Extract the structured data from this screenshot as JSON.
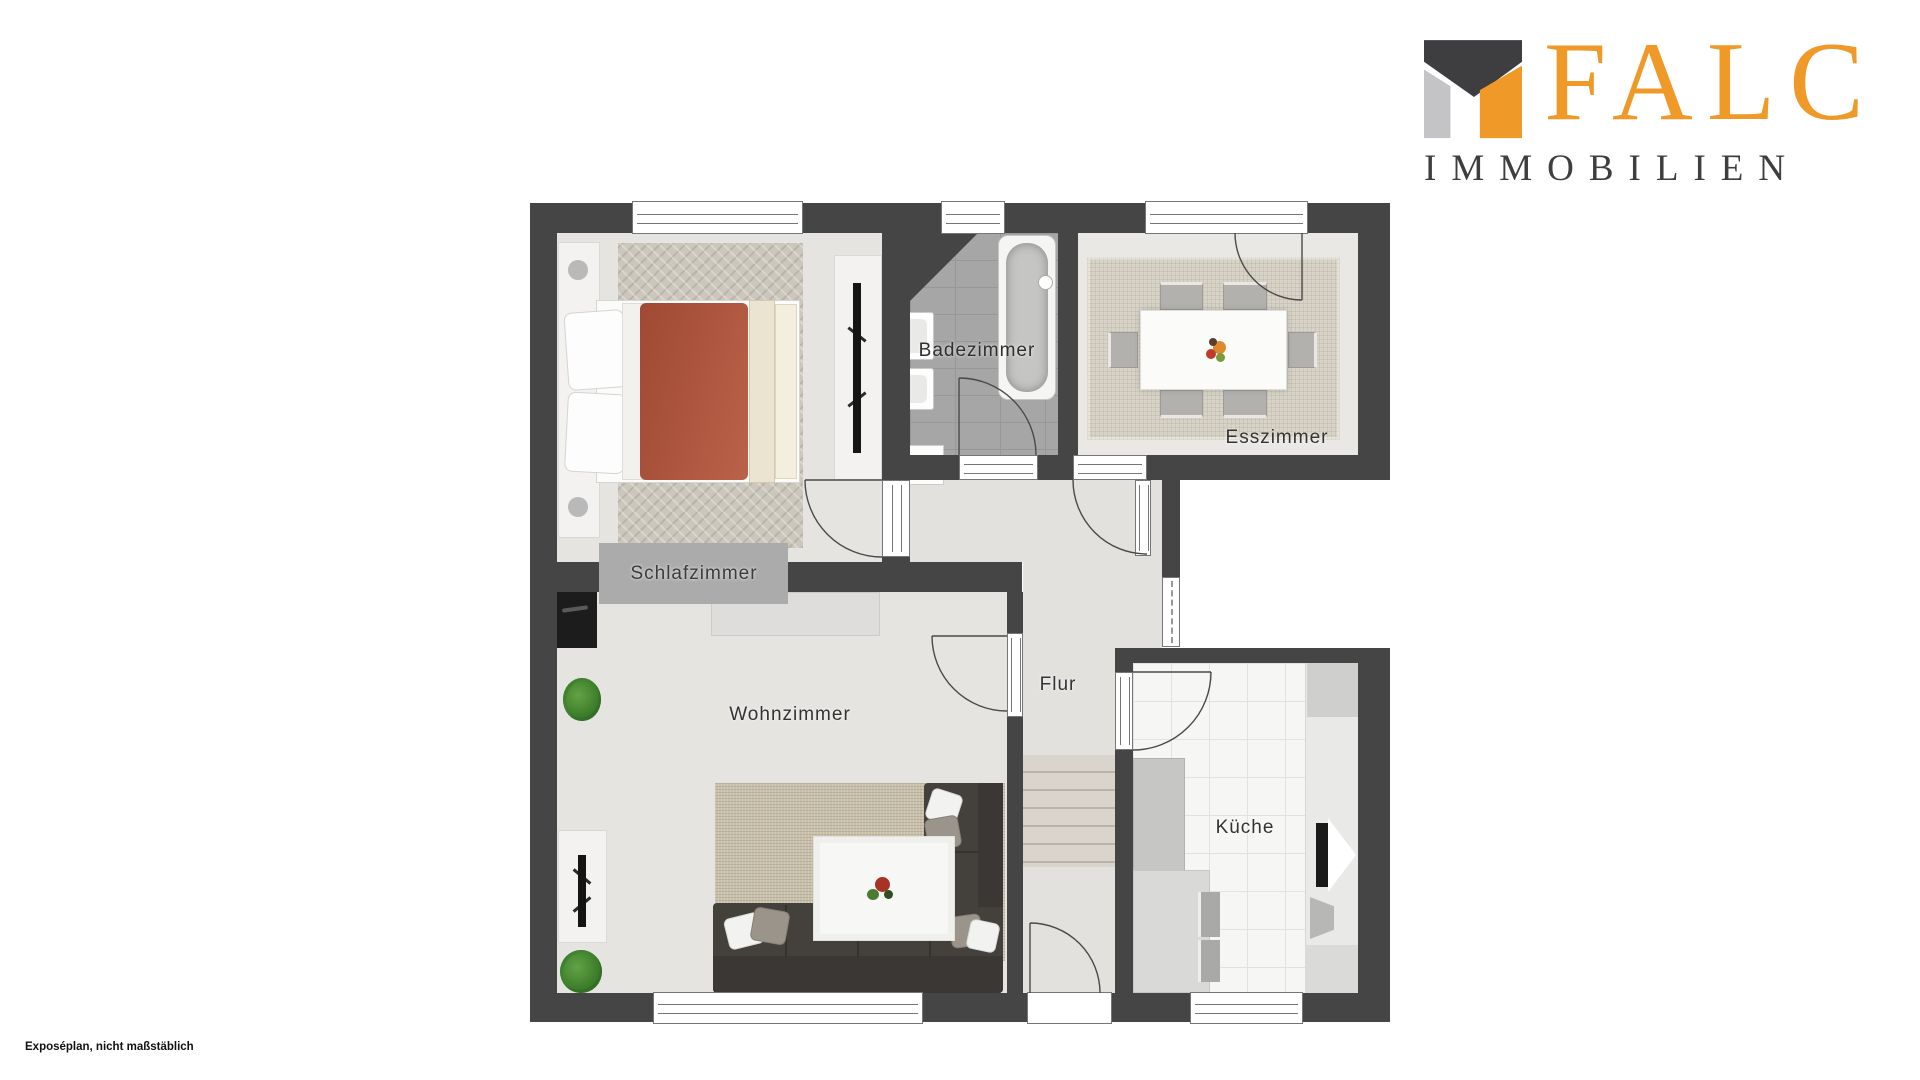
{
  "logo": {
    "brand": "FALC",
    "subtitle": "IMMOBILIEN",
    "colors": {
      "orange": "#EF9A28",
      "dark": "#3E3E40",
      "light_gray": "#C4C4C6"
    }
  },
  "footnote": "Exposéplan, nicht maßstäblich",
  "rooms": {
    "schlafzimmer": {
      "label": "Schlafzimmer"
    },
    "badezimmer": {
      "label": "Badezimmer"
    },
    "esszimmer": {
      "label": "Esszimmer"
    },
    "wohnzimmer": {
      "label": "Wohnzimmer"
    },
    "flur": {
      "label": "Flur"
    },
    "kueche": {
      "label": "Küche"
    }
  },
  "palette": {
    "wall": "#454545",
    "floor": "#E5E4E1",
    "bath_tile": "#A6A6A6",
    "kitchen_tile": "#F6F6F4",
    "bed_duvet": "#B5543A",
    "sofa": "#44413D"
  }
}
